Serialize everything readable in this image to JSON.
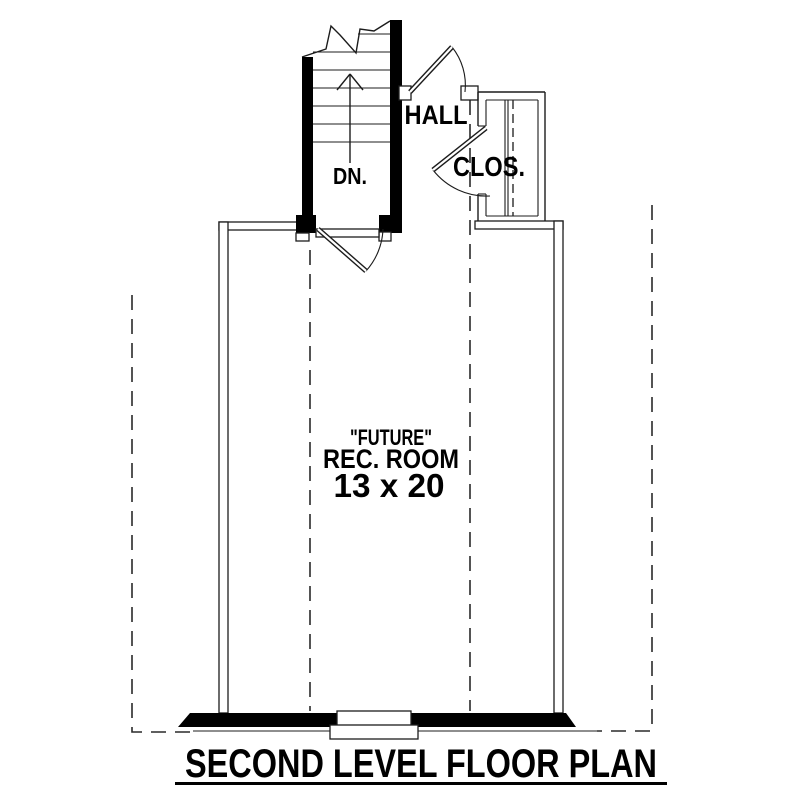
{
  "colors": {
    "background": "#ffffff",
    "ink": "#1c1c1c",
    "wall_fill": "#000000"
  },
  "plan": {
    "stairs": {
      "direction_label": "DN."
    },
    "hall": {
      "label": "HALL"
    },
    "closet": {
      "label": "CLOS."
    },
    "room": {
      "qualifier": "\"FUTURE\"",
      "name": "REC. ROOM",
      "dimensions": "13 x 20"
    },
    "title": "SECOND LEVEL FLOOR PLAN"
  }
}
